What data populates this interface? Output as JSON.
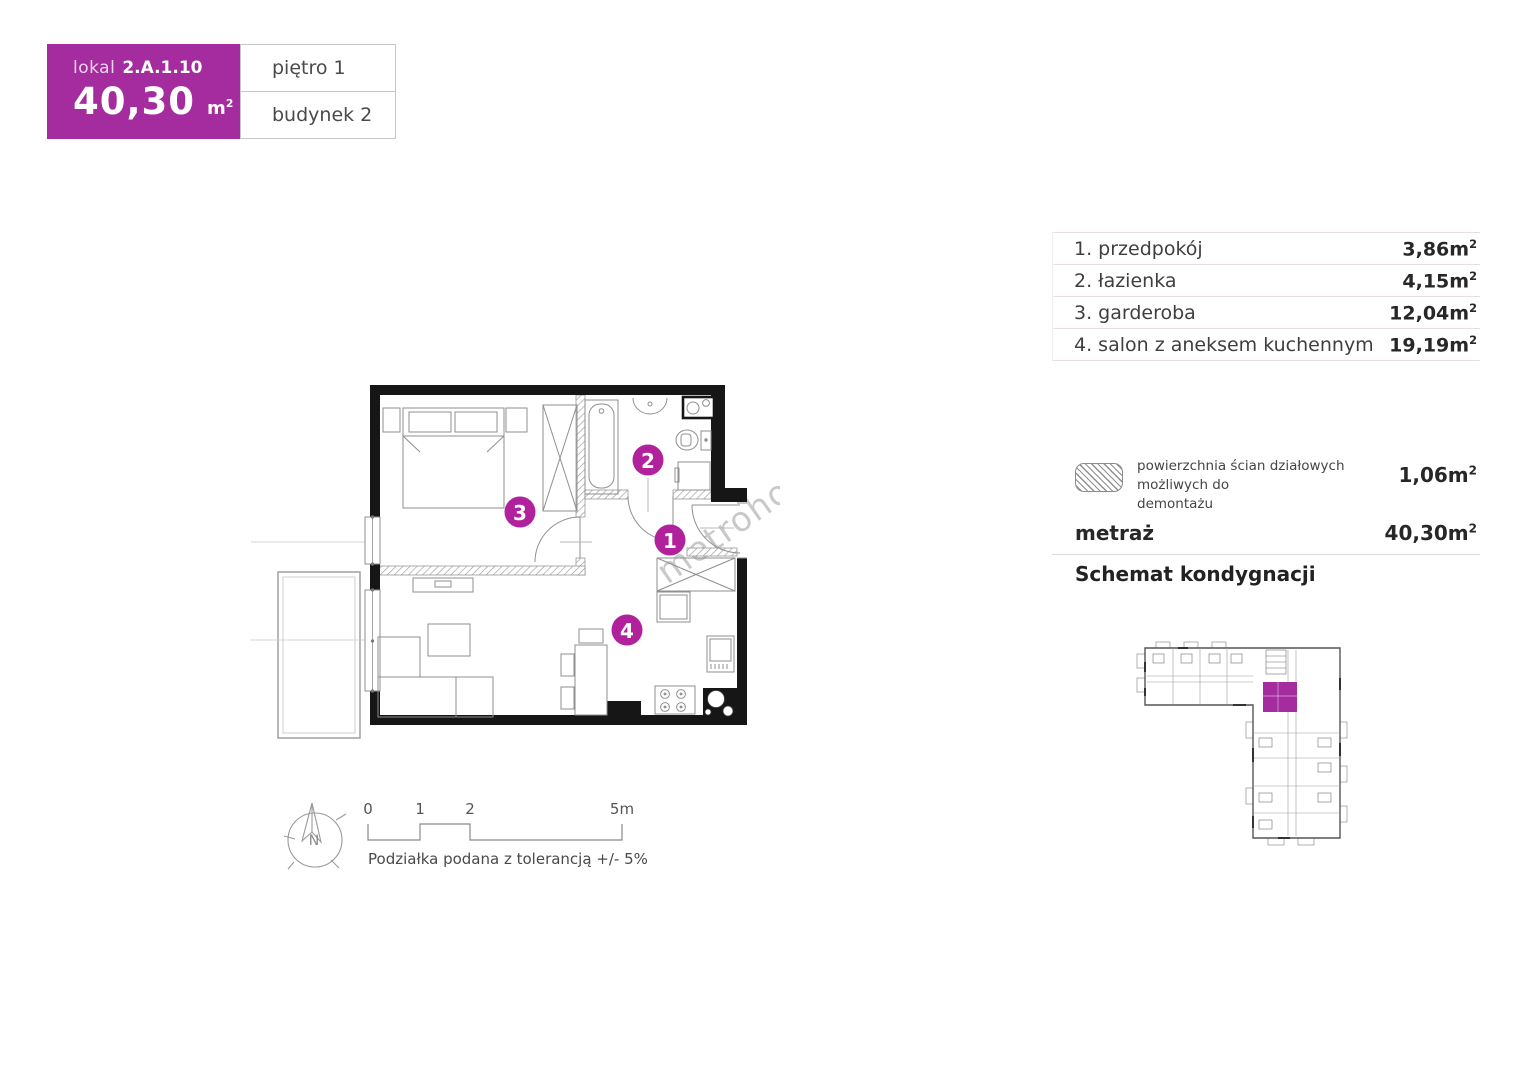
{
  "colors": {
    "accent": "#a42c9f",
    "circle": "#b0219b",
    "wall": "#161616",
    "fix": "#8f8f8f",
    "divider": "#e7dfe5",
    "textdark": "#3e3e3e",
    "textbold": "#272727",
    "wm": "#9e9e9e"
  },
  "unit_card": {
    "lokal_label": "lokal",
    "lokal_number": "2.A.1.10",
    "area_value": "40,30",
    "area_unit": "m",
    "area_sup": "2",
    "floor_label": "piętro 1",
    "building_label": "budynek 2"
  },
  "room_table": {
    "rows": [
      {
        "label": "1. przedpokój",
        "value": "3,86m",
        "sup": "2"
      },
      {
        "label": "2. łazienka",
        "value": "4,15m",
        "sup": "2"
      },
      {
        "label": "3. garderoba",
        "value": "12,04m",
        "sup": "2"
      },
      {
        "label": "4. salon z aneksem kuchennym",
        "value": "19,19m",
        "sup": "2"
      }
    ]
  },
  "legend": {
    "partition_line1": "powierzchnia ścian działowych możliwych do",
    "partition_line2": "demontażu",
    "partition_value": "1,06m",
    "partition_sup": "2",
    "metraz_label": "metraż",
    "metraz_value": "40,30m",
    "metraz_sup": "2",
    "schema_title": "Schemat kondygnacji"
  },
  "plan": {
    "room_numbers": [
      "1",
      "2",
      "3",
      "4"
    ],
    "watermark": "metrohouse",
    "compass_label": "N",
    "scale": {
      "t0": "0",
      "t1": "1",
      "t2": "2",
      "t5": "5m",
      "note": "Podziałka podana z tolerancją +/- 5%"
    }
  }
}
